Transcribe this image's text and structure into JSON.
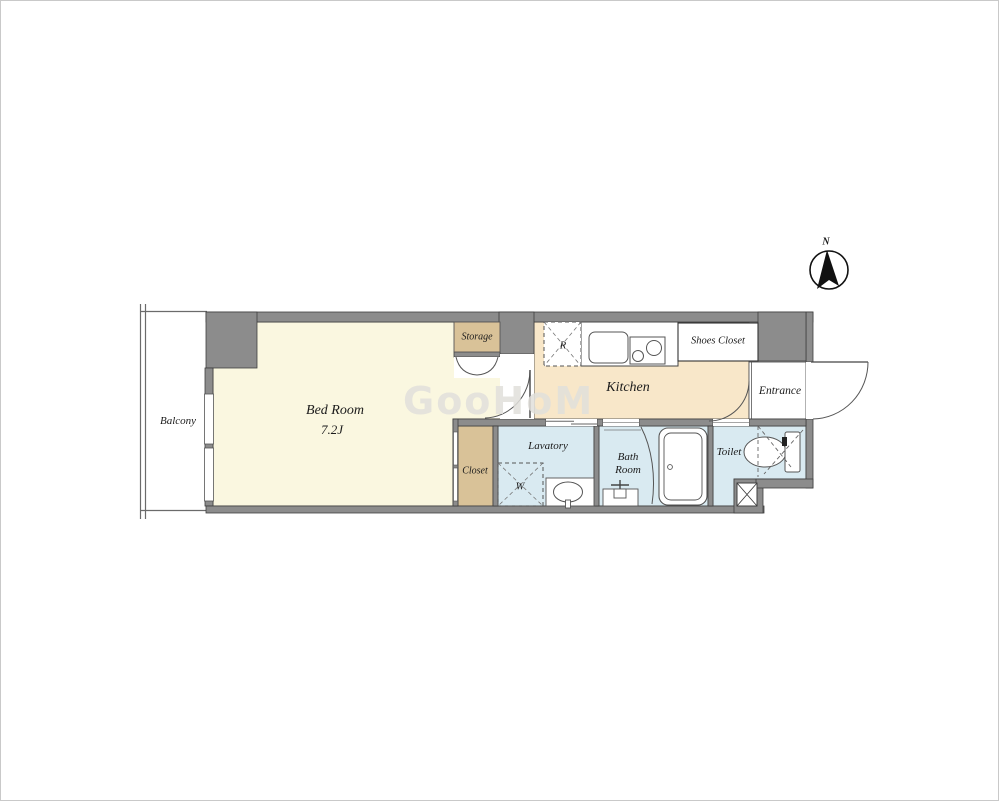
{
  "plan": {
    "type_label": "apartment-floor-plan",
    "rooms": {
      "balcony": {
        "name": "Balcony"
      },
      "bedroom": {
        "name": "Bed Room",
        "size": "7.2J"
      },
      "storage": {
        "name": "Storage"
      },
      "closet": {
        "name": "Closet"
      },
      "kitchen": {
        "name": "Kitchen"
      },
      "shoes_closet": {
        "name": "Shoes Closet"
      },
      "entrance": {
        "name": "Entrance"
      },
      "lavatory": {
        "name": "Lavatory"
      },
      "bath": {
        "line1": "Bath",
        "line2": "Room"
      },
      "toilet": {
        "name": "Toilet"
      }
    },
    "fixtures": {
      "refrigerator_label": "R",
      "washer_label": "W"
    },
    "compass": {
      "label": "N"
    },
    "watermark": {
      "text": "GooHoM"
    },
    "colors": {
      "bedroom_floor": "#faf7e0",
      "kitchen_floor": "#f8e7c9",
      "wet_area_floor": "#d9eaf1",
      "closet_floor": "#d9c298",
      "wall": "#8c8c8c",
      "line": "#3f3f3f"
    }
  }
}
